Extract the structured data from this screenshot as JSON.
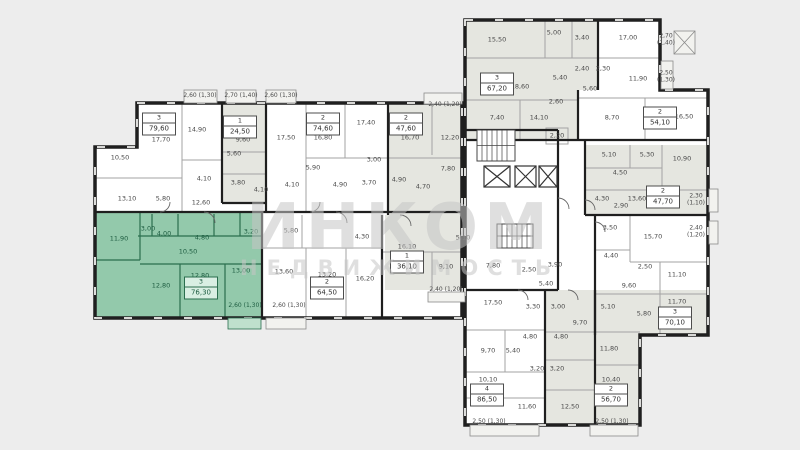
{
  "meta": {
    "colors": {
      "background": "#ededed",
      "floor": "#ffffff",
      "unit_gray": "#e5e6e0",
      "highlight_fill": "#93c9ab",
      "highlight_wall": "#2a6e4e",
      "highlight_text": "#1d5c40",
      "wall": "#1f1f1f",
      "text": "#4a4a4a",
      "watermark": "#c6c6c6"
    }
  },
  "watermark": {
    "line1": "ИНКОМ",
    "line2": "НЕДВИЖИМОСТЬ"
  },
  "apartments": [
    {
      "type": "3",
      "area": "79,60",
      "selected": false,
      "badge": {
        "x": 159,
        "y": 124
      },
      "rooms": [
        {
          "label": "17,70",
          "x": 161,
          "y": 140
        },
        {
          "label": "14,90",
          "x": 197,
          "y": 130
        },
        {
          "label": "10,50",
          "x": 120,
          "y": 158
        },
        {
          "label": "13,10",
          "x": 127,
          "y": 199
        },
        {
          "label": "5,80",
          "x": 163,
          "y": 199
        },
        {
          "label": "12,60",
          "x": 201,
          "y": 203
        },
        {
          "label": "4,10",
          "x": 204,
          "y": 179
        }
      ],
      "balconies": []
    },
    {
      "type": "1",
      "area": "24,50",
      "selected": false,
      "badge": {
        "x": 240,
        "y": 127
      },
      "rooms": [
        {
          "label": "9,60",
          "x": 243,
          "y": 140
        },
        {
          "label": "5,60",
          "x": 234,
          "y": 154
        },
        {
          "label": "3,80",
          "x": 238,
          "y": 183
        },
        {
          "label": "4,10",
          "x": 261,
          "y": 190
        }
      ],
      "balconies": []
    },
    {
      "type": "2",
      "area": "74,60",
      "selected": false,
      "badge": {
        "x": 323,
        "y": 124
      },
      "rooms": [
        {
          "label": "17,50",
          "x": 286,
          "y": 138
        },
        {
          "label": "16,80",
          "x": 323,
          "y": 138
        },
        {
          "label": "17,40",
          "x": 366,
          "y": 123
        },
        {
          "label": "5,90",
          "x": 313,
          "y": 168
        },
        {
          "label": "3,00",
          "x": 374,
          "y": 160
        },
        {
          "label": "4,10",
          "x": 292,
          "y": 185
        },
        {
          "label": "4,90",
          "x": 340,
          "y": 185
        },
        {
          "label": "3,70",
          "x": 369,
          "y": 183
        }
      ],
      "balconies": []
    },
    {
      "type": "2",
      "area": "47,60",
      "selected": false,
      "badge": {
        "x": 406,
        "y": 124
      },
      "rooms": [
        {
          "label": "16,70",
          "x": 410,
          "y": 138
        },
        {
          "label": "12,20",
          "x": 450,
          "y": 138
        },
        {
          "label": "7,80",
          "x": 448,
          "y": 169
        },
        {
          "label": "4,90",
          "x": 399,
          "y": 180
        },
        {
          "label": "4,70",
          "x": 423,
          "y": 187
        }
      ],
      "balconies": []
    },
    {
      "type": "3",
      "area": "76,30",
      "selected": true,
      "badge": {
        "x": 201,
        "y": 288
      },
      "rooms": [
        {
          "label": "11,90",
          "x": 119,
          "y": 239
        },
        {
          "label": "3,00",
          "x": 148,
          "y": 229
        },
        {
          "label": "4,00",
          "x": 164,
          "y": 234
        },
        {
          "label": "4,80",
          "x": 202,
          "y": 238
        },
        {
          "label": "3,20",
          "x": 251,
          "y": 232
        },
        {
          "label": "10,50",
          "x": 188,
          "y": 252
        },
        {
          "label": "13,00",
          "x": 241,
          "y": 271
        },
        {
          "label": "12,80",
          "x": 161,
          "y": 286
        },
        {
          "label": "12,80",
          "x": 200,
          "y": 276
        }
      ],
      "balconies": [
        {
          "label": "2,60 (1,30)",
          "x": 245,
          "y": 306
        }
      ]
    },
    {
      "type": "2",
      "area": "64,50",
      "selected": false,
      "badge": {
        "x": 327,
        "y": 288
      },
      "rooms": [
        {
          "label": "5,80",
          "x": 291,
          "y": 231
        },
        {
          "label": "4,30",
          "x": 362,
          "y": 237
        },
        {
          "label": "13,60",
          "x": 284,
          "y": 272
        },
        {
          "label": "13,20",
          "x": 327,
          "y": 275
        },
        {
          "label": "16,20",
          "x": 365,
          "y": 279
        }
      ],
      "balconies": [
        {
          "label": "2,60 (1,30)",
          "x": 289,
          "y": 306
        }
      ]
    },
    {
      "type": "1",
      "area": "36,10",
      "selected": false,
      "badge": {
        "x": 407,
        "y": 262
      },
      "rooms": [
        {
          "label": "16,10",
          "x": 407,
          "y": 247
        },
        {
          "label": "5,10",
          "x": 463,
          "y": 238
        },
        {
          "label": "9,10",
          "x": 446,
          "y": 267
        }
      ],
      "balconies": [
        {
          "label": "2,40 (1,20)",
          "x": 446,
          "y": 290
        }
      ]
    },
    {
      "type": "3",
      "area": "67,20",
      "selected": false,
      "badge": {
        "x": 497,
        "y": 84
      },
      "rooms": [
        {
          "label": "15,50",
          "x": 497,
          "y": 40
        },
        {
          "label": "5,00",
          "x": 554,
          "y": 33
        },
        {
          "label": "3,40",
          "x": 582,
          "y": 38
        },
        {
          "label": "18,60",
          "x": 520,
          "y": 87
        },
        {
          "label": "2,60",
          "x": 556,
          "y": 102
        },
        {
          "label": "7,40",
          "x": 497,
          "y": 118
        },
        {
          "label": "14,10",
          "x": 539,
          "y": 118
        }
      ],
      "balconies": []
    },
    {
      "type": "2",
      "area": "54,10",
      "selected": false,
      "badge": {
        "x": 660,
        "y": 118
      },
      "rooms": [
        {
          "label": "17,00",
          "x": 628,
          "y": 38
        },
        {
          "label": "2,40",
          "x": 582,
          "y": 69
        },
        {
          "label": "2,30",
          "x": 603,
          "y": 69
        },
        {
          "label": "5,40",
          "x": 560,
          "y": 78
        },
        {
          "label": "11,90",
          "x": 638,
          "y": 79
        },
        {
          "label": "5,60",
          "x": 590,
          "y": 89
        },
        {
          "label": "8,70",
          "x": 612,
          "y": 118
        },
        {
          "label": "16,50",
          "x": 684,
          "y": 117
        }
      ],
      "balconies": [
        {
          "label": "2,70 (1,40)",
          "x": 666,
          "y": 40,
          "stacked": true
        },
        {
          "label": "2,50 (1,30)",
          "x": 666,
          "y": 77,
          "stacked": true
        }
      ]
    },
    {
      "type": "2",
      "area": "47,70",
      "selected": false,
      "badge": {
        "x": 663,
        "y": 197
      },
      "rooms": [
        {
          "label": "5,10",
          "x": 609,
          "y": 155
        },
        {
          "label": "5,30",
          "x": 647,
          "y": 155
        },
        {
          "label": "10,90",
          "x": 682,
          "y": 159
        },
        {
          "label": "4,50",
          "x": 620,
          "y": 173
        },
        {
          "label": "4,30",
          "x": 602,
          "y": 199
        },
        {
          "label": "2,90",
          "x": 621,
          "y": 206
        },
        {
          "label": "13,60",
          "x": 637,
          "y": 199
        }
      ],
      "balconies": [
        {
          "label": "2,30 (1,10)",
          "x": 696,
          "y": 200,
          "stacked": true
        }
      ]
    },
    {
      "type": "3",
      "area": "70,10",
      "selected": false,
      "badge": {
        "x": 675,
        "y": 318
      },
      "rooms": [
        {
          "label": "3,50",
          "x": 610,
          "y": 228
        },
        {
          "label": "15,70",
          "x": 653,
          "y": 237
        },
        {
          "label": "4,40",
          "x": 611,
          "y": 256
        },
        {
          "label": "2,50",
          "x": 645,
          "y": 267
        },
        {
          "label": "11,10",
          "x": 677,
          "y": 275
        },
        {
          "label": "9,60",
          "x": 629,
          "y": 286
        },
        {
          "label": "5,10",
          "x": 608,
          "y": 307
        },
        {
          "label": "11,70",
          "x": 677,
          "y": 302
        },
        {
          "label": "5,80",
          "x": 644,
          "y": 314
        }
      ],
      "balconies": [
        {
          "label": "2,40 (1,20)",
          "x": 696,
          "y": 232,
          "stacked": true
        }
      ]
    },
    {
      "type": "4",
      "area": "86,50",
      "selected": false,
      "badge": {
        "x": 487,
        "y": 395
      },
      "rooms": [
        {
          "label": "17,50",
          "x": 493,
          "y": 303
        },
        {
          "label": "3,30",
          "x": 533,
          "y": 307
        },
        {
          "label": "4,80",
          "x": 530,
          "y": 337
        },
        {
          "label": "9,70",
          "x": 488,
          "y": 351
        },
        {
          "label": "5,40",
          "x": 513,
          "y": 351
        },
        {
          "label": "3,20",
          "x": 537,
          "y": 369
        },
        {
          "label": "10,10",
          "x": 488,
          "y": 380
        },
        {
          "label": "11,60",
          "x": 527,
          "y": 407
        }
      ],
      "balconies": [
        {
          "label": "2,50 (1,30)",
          "x": 489,
          "y": 422
        }
      ]
    },
    {
      "type": "2",
      "area": "56,70",
      "selected": false,
      "badge": {
        "x": 611,
        "y": 395
      },
      "rooms": [
        {
          "label": "3,00",
          "x": 558,
          "y": 307
        },
        {
          "label": "9,70",
          "x": 580,
          "y": 323
        },
        {
          "label": "4,80",
          "x": 561,
          "y": 337
        },
        {
          "label": "3,20",
          "x": 557,
          "y": 369
        },
        {
          "label": "11,80",
          "x": 609,
          "y": 349
        },
        {
          "label": "10,40",
          "x": 611,
          "y": 380
        },
        {
          "label": "12,50",
          "x": 570,
          "y": 407
        }
      ],
      "balconies": [
        {
          "label": "2,50 (1,30)",
          "x": 612,
          "y": 422
        }
      ]
    }
  ],
  "shared_labels": [
    {
      "label": "2,60 (1,30)",
      "x": 200,
      "y": 96
    },
    {
      "label": "2,70 (1,40)",
      "x": 241,
      "y": 96
    },
    {
      "label": "2,60 (1,30)",
      "x": 281,
      "y": 96
    },
    {
      "label": "2,40 (1,20)",
      "x": 445,
      "y": 105
    },
    {
      "label": "2,20",
      "x": 557,
      "y": 136
    },
    {
      "label": "7,80",
      "x": 493,
      "y": 266
    },
    {
      "label": "2,50",
      "x": 529,
      "y": 270
    },
    {
      "label": "3,90",
      "x": 555,
      "y": 265
    },
    {
      "label": "5,40",
      "x": 546,
      "y": 284
    }
  ]
}
